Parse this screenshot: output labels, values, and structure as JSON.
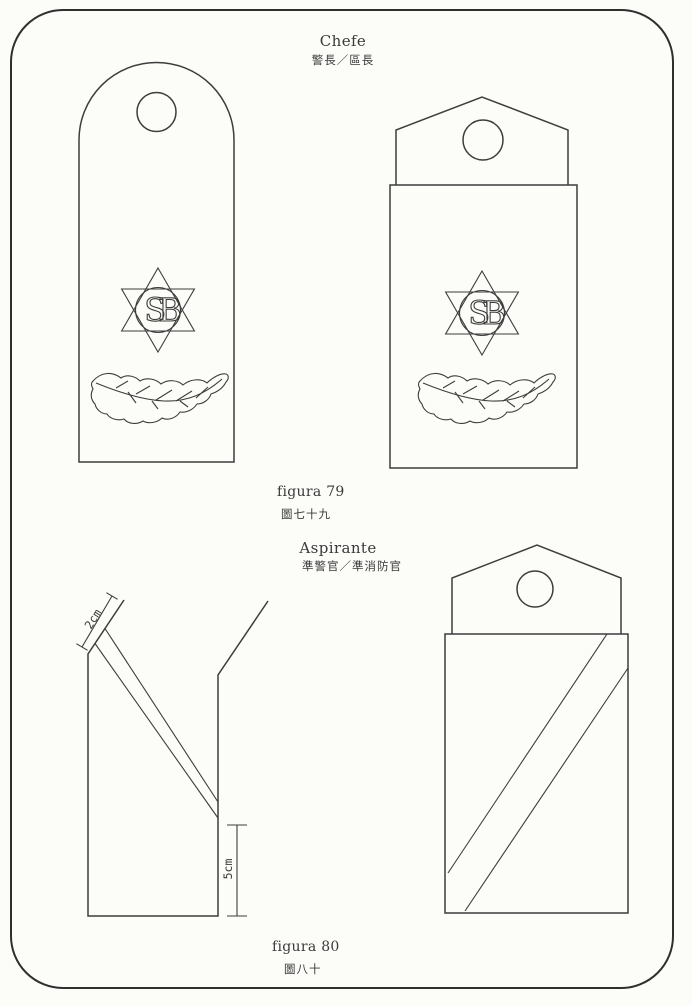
{
  "document": {
    "kind": "uniform-insignia-plate-scan",
    "paper_color": "#fcfcf9",
    "line_color": "#3d3d3d",
    "border_color": "#2f2f2f"
  },
  "emblem": {
    "monogram": "SB",
    "star": "six-pointed-star-badge",
    "wreath": "leaf-spray"
  },
  "figures": [
    {
      "rank_pt": "Chefe",
      "rank_zh": "警長／區長",
      "caption_pt": "figura 79",
      "caption_zh": "圖七十九"
    },
    {
      "rank_pt": "Aspirante",
      "rank_zh": "準警官／準消防官",
      "caption_pt": "figura 80",
      "caption_zh": "圖八十",
      "dimensions": {
        "stripe_width": "2cm",
        "stripe_bottom_offset": "5cm"
      }
    }
  ]
}
